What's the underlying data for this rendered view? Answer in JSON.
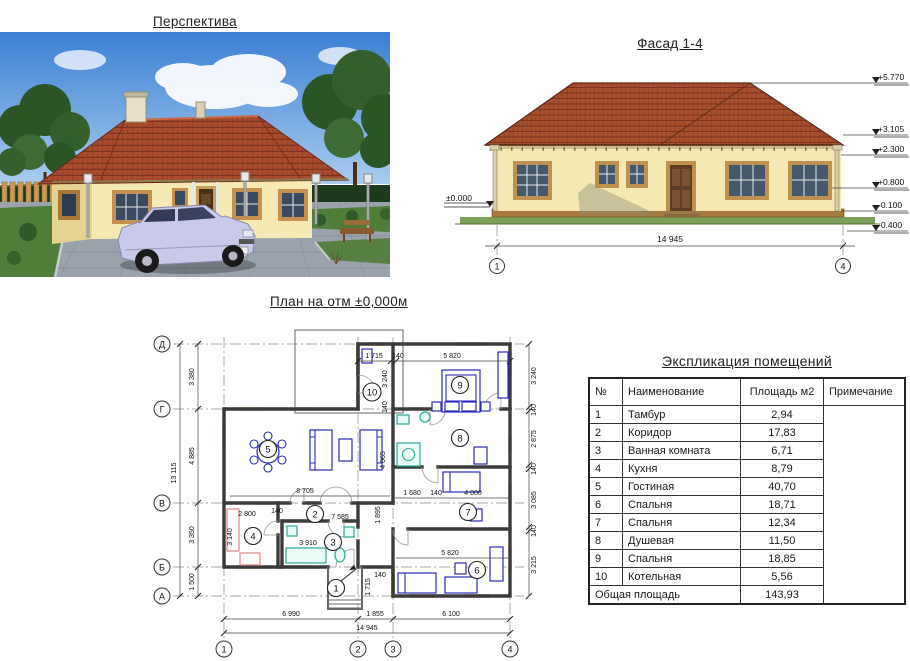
{
  "perspective": {
    "title": "Перспектива"
  },
  "facade": {
    "title": "Фасад 1-4",
    "zero_mark": "±0.000",
    "marks": [
      "+5.770",
      "+3.105",
      "+2.300",
      "+0.800",
      "-0.100",
      "-0.400"
    ],
    "overall_dim": "14 945",
    "axis_start": "1",
    "axis_end": "4"
  },
  "plan": {
    "title": "План на отм ±0,000м",
    "grid_rows": [
      "Д",
      "Г",
      "В",
      "Б",
      "А"
    ],
    "grid_cols": [
      "1",
      "2",
      "3",
      "4"
    ],
    "left_total": "13 115",
    "left_dims": [
      "3 380",
      "4 885",
      "3 350",
      "1 500"
    ],
    "bottom_dims": [
      "6 990",
      "1 855",
      "6 100"
    ],
    "bottom_total": "14 945",
    "right_dims": [
      "3 240",
      "140",
      "2 875",
      "140",
      "3 085",
      "140",
      "3 215"
    ],
    "top_dims": [
      "1 715",
      "140",
      "5 820"
    ],
    "inner_dims": {
      "living_width": "8 705",
      "hall_width": "7 585",
      "kitchen_width": "2 800",
      "bath_width": "3 910",
      "kitchen_depth": "3 140",
      "hall_depth": "4 065",
      "hall_depth2": "1 895",
      "seg_a": "1 680",
      "room7_width": "4 000",
      "room6_width": "5 820",
      "entry_depth": "1 715",
      "boiler_depth": "3 240",
      "wall_thickness": "140"
    },
    "room_numbers": [
      "1",
      "2",
      "3",
      "4",
      "5",
      "6",
      "7",
      "8",
      "9",
      "10"
    ]
  },
  "schedule": {
    "title": "Экспликация помещений",
    "headers": [
      "№",
      "Наименование",
      "Площадь м2",
      "Примечание"
    ],
    "rows": [
      {
        "num": "1",
        "name": "Тамбур",
        "area": "2,94"
      },
      {
        "num": "2",
        "name": "Коридор",
        "area": "17,83"
      },
      {
        "num": "3",
        "name": "Ванная комната",
        "area": "6,71"
      },
      {
        "num": "4",
        "name": "Кухня",
        "area": "8,79"
      },
      {
        "num": "5",
        "name": "Гостиная",
        "area": "40,70"
      },
      {
        "num": "6",
        "name": "Спальня",
        "area": "18,71"
      },
      {
        "num": "7",
        "name": "Спальня",
        "area": "12,34"
      },
      {
        "num": "8",
        "name": "Душевая",
        "area": "11,50"
      },
      {
        "num": "9",
        "name": "Спальня",
        "area": "18,85"
      },
      {
        "num": "10",
        "name": "Котельная",
        "area": "5,56"
      }
    ],
    "total_label": "Общая площадь",
    "total_area": "143,93"
  },
  "colors": {
    "roof": "#a8502e",
    "wall": "#f5e8b2",
    "frame": "#c09050",
    "ground": "#7da05a",
    "furniture": "#2a2ab8",
    "fixture": "#2aa896",
    "window_mark": "#e8963c"
  }
}
